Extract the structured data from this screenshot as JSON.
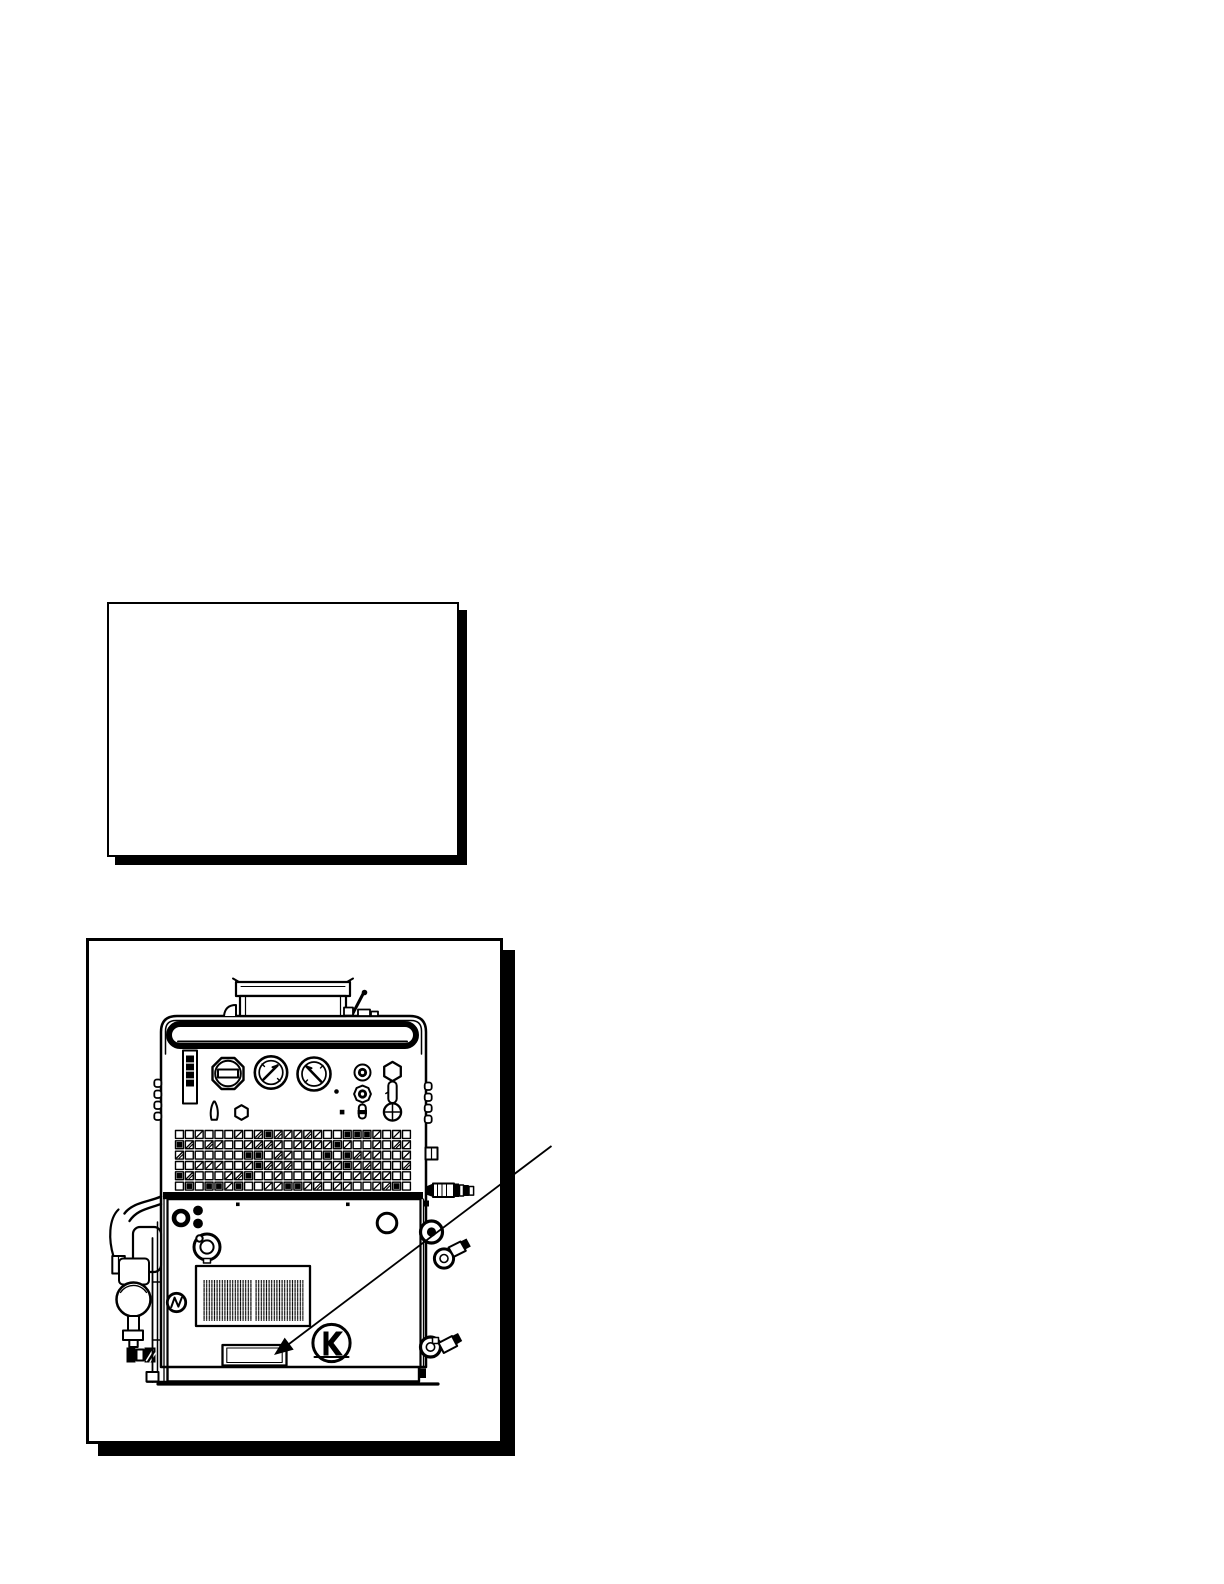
{
  "page": {
    "background_color": "#ffffff",
    "ink_color": "#000000"
  },
  "empty_panel": {
    "content": ""
  },
  "illustration": {
    "subject": "engine-driven-welder-generator-front-view",
    "callout": {
      "target": "nameplate",
      "arrow_style": "solid-filled-arrowhead"
    },
    "part_icons": [
      "muffler-housing-icon",
      "lift-handle-icon",
      "control-label-icon",
      "fuel-cap-icon",
      "left-gauge-icon",
      "right-gauge-icon",
      "control-knob-icon",
      "toggle-switch-icon",
      "louver-grid-icon",
      "divider-band-icon",
      "lower-panel-icon",
      "vent-grille-icon",
      "nameplate-icon",
      "engine-badge-icon",
      "fuel-valve-icon",
      "left-plumbing-icon",
      "right-connectors-icon",
      "skid-base-icon"
    ]
  }
}
